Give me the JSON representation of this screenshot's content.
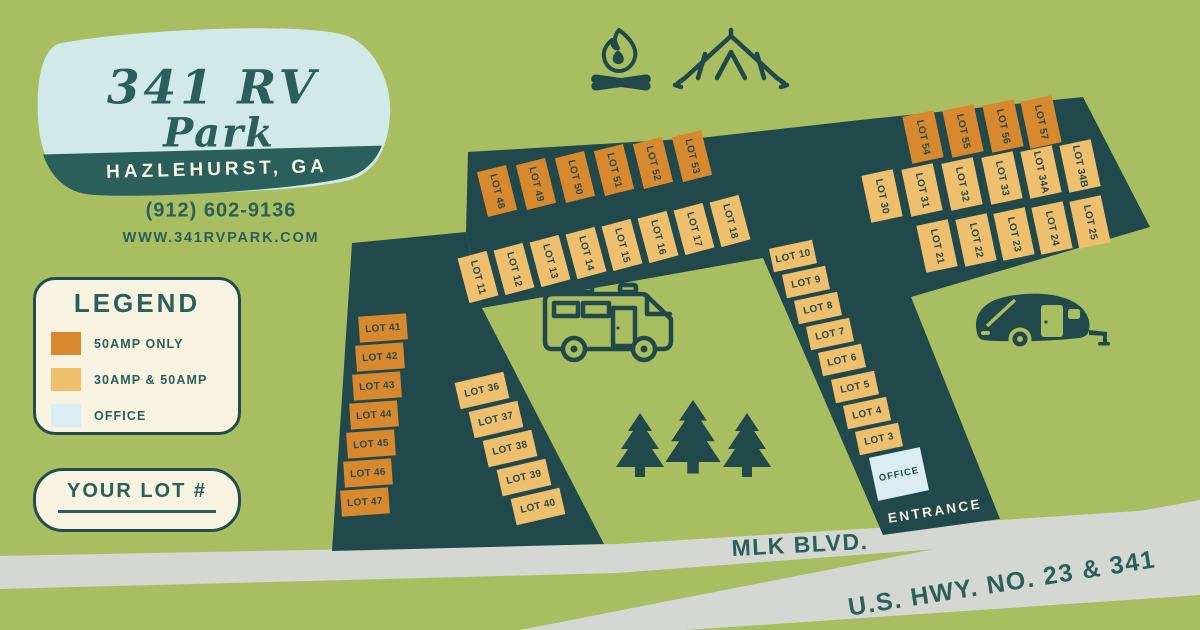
{
  "logo": {
    "title_line1": "341 RV",
    "title_line2": "Park",
    "banner": "HAZLEHURST, GA"
  },
  "contact": {
    "phone": "(912) 602-9136",
    "website": "WWW.341RVPARK.COM"
  },
  "legend": {
    "title": "LEGEND",
    "items": [
      {
        "label": "50AMP ONLY",
        "color": "#d8892e"
      },
      {
        "label": "30AMP & 50AMP",
        "color": "#eec06d"
      },
      {
        "label": "OFFICE",
        "color": "#d9edf2"
      }
    ]
  },
  "your_lot": {
    "label": "YOUR LOT #"
  },
  "map": {
    "entrance_label": "ENTRANCE",
    "roads": [
      {
        "label": "MLK BLVD."
      },
      {
        "label": "U.S. HWY. NO. 23 & 341"
      }
    ],
    "icons": [
      "campfire-icon",
      "tent-icon",
      "rv-motorhome-icon",
      "pine-trees-icon",
      "camper-trailer-icon"
    ],
    "lots": [
      {
        "label": "LOT 48",
        "type": "50amp",
        "x": 497,
        "y": 191,
        "w": 30,
        "h": 46,
        "r": -14,
        "v": true
      },
      {
        "label": "LOT 49",
        "type": "50amp",
        "x": 536,
        "y": 184,
        "w": 30,
        "h": 46,
        "r": -14,
        "v": true
      },
      {
        "label": "LOT 50",
        "type": "50amp",
        "x": 575,
        "y": 177,
        "w": 30,
        "h": 46,
        "r": -14,
        "v": true
      },
      {
        "label": "LOT 51",
        "type": "50amp",
        "x": 614,
        "y": 170,
        "w": 30,
        "h": 46,
        "r": -14,
        "v": true
      },
      {
        "label": "LOT 52",
        "type": "50amp",
        "x": 653,
        "y": 163,
        "w": 30,
        "h": 46,
        "r": -14,
        "v": true
      },
      {
        "label": "LOT 53",
        "type": "50amp",
        "x": 692,
        "y": 156,
        "w": 30,
        "h": 46,
        "r": -14,
        "v": true
      },
      {
        "label": "LOT 11",
        "type": "30_50amp",
        "x": 478,
        "y": 277,
        "w": 30,
        "h": 46,
        "r": -15,
        "v": true
      },
      {
        "label": "LOT 12",
        "type": "30_50amp",
        "x": 514,
        "y": 269,
        "w": 30,
        "h": 46,
        "r": -15,
        "v": true
      },
      {
        "label": "LOT 13",
        "type": "30_50amp",
        "x": 550,
        "y": 261,
        "w": 30,
        "h": 46,
        "r": -15,
        "v": true
      },
      {
        "label": "LOT 14",
        "type": "30_50amp",
        "x": 586,
        "y": 253,
        "w": 30,
        "h": 46,
        "r": -15,
        "v": true
      },
      {
        "label": "LOT 15",
        "type": "30_50amp",
        "x": 622,
        "y": 245,
        "w": 30,
        "h": 46,
        "r": -15,
        "v": true
      },
      {
        "label": "LOT 16",
        "type": "30_50amp",
        "x": 658,
        "y": 237,
        "w": 30,
        "h": 46,
        "r": -15,
        "v": true
      },
      {
        "label": "LOT 17",
        "type": "30_50amp",
        "x": 694,
        "y": 229,
        "w": 30,
        "h": 46,
        "r": -15,
        "v": true
      },
      {
        "label": "LOT 18",
        "type": "30_50amp",
        "x": 730,
        "y": 221,
        "w": 30,
        "h": 46,
        "r": -15,
        "v": true
      },
      {
        "label": "LOT 54",
        "type": "50amp",
        "x": 923,
        "y": 137,
        "w": 32,
        "h": 48,
        "r": -12,
        "v": true
      },
      {
        "label": "LOT 55",
        "type": "50amp",
        "x": 963,
        "y": 131,
        "w": 32,
        "h": 48,
        "r": -12,
        "v": true
      },
      {
        "label": "LOT 56",
        "type": "50amp",
        "x": 1003,
        "y": 126,
        "w": 32,
        "h": 48,
        "r": -12,
        "v": true
      },
      {
        "label": "LOT 57",
        "type": "50amp",
        "x": 1041,
        "y": 122,
        "w": 32,
        "h": 48,
        "r": -12,
        "v": true
      },
      {
        "label": "LOT 30",
        "type": "30_50amp",
        "x": 882,
        "y": 196,
        "w": 32,
        "h": 48,
        "r": -12,
        "v": true
      },
      {
        "label": "LOT 31",
        "type": "30_50amp",
        "x": 922,
        "y": 190,
        "w": 32,
        "h": 48,
        "r": -12,
        "v": true
      },
      {
        "label": "LOT 32",
        "type": "30_50amp",
        "x": 962,
        "y": 184,
        "w": 32,
        "h": 48,
        "r": -12,
        "v": true
      },
      {
        "label": "LOT 33",
        "type": "30_50amp",
        "x": 1002,
        "y": 178,
        "w": 32,
        "h": 48,
        "r": -12,
        "v": true
      },
      {
        "label": "LOT 34A",
        "type": "30_50amp",
        "x": 1041,
        "y": 172,
        "w": 32,
        "h": 48,
        "r": -12,
        "v": true
      },
      {
        "label": "LOT 34B",
        "type": "30_50amp",
        "x": 1080,
        "y": 166,
        "w": 32,
        "h": 48,
        "r": -12,
        "v": true
      },
      {
        "label": "LOT 21",
        "type": "30_50amp",
        "x": 937,
        "y": 246,
        "w": 32,
        "h": 48,
        "r": -12,
        "v": true
      },
      {
        "label": "LOT 22",
        "type": "30_50amp",
        "x": 976,
        "y": 240,
        "w": 32,
        "h": 48,
        "r": -12,
        "v": true
      },
      {
        "label": "LOT 23",
        "type": "30_50amp",
        "x": 1014,
        "y": 234,
        "w": 32,
        "h": 48,
        "r": -12,
        "v": true
      },
      {
        "label": "LOT 24",
        "type": "30_50amp",
        "x": 1052,
        "y": 228,
        "w": 32,
        "h": 48,
        "r": -12,
        "v": true
      },
      {
        "label": "LOT 25",
        "type": "30_50amp",
        "x": 1090,
        "y": 222,
        "w": 32,
        "h": 48,
        "r": -12,
        "v": true
      },
      {
        "label": "LOT 10",
        "type": "30_50amp",
        "x": 793,
        "y": 256,
        "w": 44,
        "h": 24,
        "r": -12,
        "v": false
      },
      {
        "label": "LOT 9",
        "type": "30_50amp",
        "x": 806,
        "y": 282,
        "w": 44,
        "h": 24,
        "r": -12,
        "v": false
      },
      {
        "label": "LOT 8",
        "type": "30_50amp",
        "x": 818,
        "y": 308,
        "w": 44,
        "h": 24,
        "r": -12,
        "v": false
      },
      {
        "label": "LOT 7",
        "type": "30_50amp",
        "x": 830,
        "y": 334,
        "w": 44,
        "h": 24,
        "r": -12,
        "v": false
      },
      {
        "label": "LOT 6",
        "type": "30_50amp",
        "x": 842,
        "y": 360,
        "w": 44,
        "h": 24,
        "r": -12,
        "v": false
      },
      {
        "label": "LOT 5",
        "type": "30_50amp",
        "x": 855,
        "y": 387,
        "w": 44,
        "h": 24,
        "r": -12,
        "v": false
      },
      {
        "label": "LOT 4",
        "type": "30_50amp",
        "x": 867,
        "y": 413,
        "w": 44,
        "h": 24,
        "r": -12,
        "v": false
      },
      {
        "label": "LOT 3",
        "type": "30_50amp",
        "x": 879,
        "y": 439,
        "w": 44,
        "h": 24,
        "r": -12,
        "v": false
      },
      {
        "label": "OFFICE",
        "type": "office",
        "x": 899,
        "y": 474,
        "w": 52,
        "h": 44,
        "r": -12,
        "v": false
      },
      {
        "label": "LOT 41",
        "type": "50amp",
        "x": 383,
        "y": 328,
        "w": 48,
        "h": 26,
        "r": -4,
        "v": false
      },
      {
        "label": "LOT 42",
        "type": "50amp",
        "x": 380,
        "y": 357,
        "w": 48,
        "h": 26,
        "r": -4,
        "v": false
      },
      {
        "label": "LOT 43",
        "type": "50amp",
        "x": 377,
        "y": 386,
        "w": 48,
        "h": 26,
        "r": -4,
        "v": false
      },
      {
        "label": "LOT 44",
        "type": "50amp",
        "x": 374,
        "y": 415,
        "w": 48,
        "h": 26,
        "r": -4,
        "v": false
      },
      {
        "label": "LOT 45",
        "type": "50amp",
        "x": 371,
        "y": 444,
        "w": 48,
        "h": 26,
        "r": -4,
        "v": false
      },
      {
        "label": "LOT 46",
        "type": "50amp",
        "x": 368,
        "y": 473,
        "w": 48,
        "h": 26,
        "r": -4,
        "v": false
      },
      {
        "label": "LOT 47",
        "type": "50amp",
        "x": 365,
        "y": 502,
        "w": 48,
        "h": 26,
        "r": -4,
        "v": false
      },
      {
        "label": "LOT 36",
        "type": "30_50amp",
        "x": 482,
        "y": 390,
        "w": 50,
        "h": 27,
        "r": -13,
        "v": false
      },
      {
        "label": "LOT 37",
        "type": "30_50amp",
        "x": 496,
        "y": 419,
        "w": 50,
        "h": 27,
        "r": -13,
        "v": false
      },
      {
        "label": "LOT 38",
        "type": "30_50amp",
        "x": 510,
        "y": 448,
        "w": 50,
        "h": 27,
        "r": -13,
        "v": false
      },
      {
        "label": "LOT 39",
        "type": "30_50amp",
        "x": 524,
        "y": 477,
        "w": 50,
        "h": 27,
        "r": -13,
        "v": false
      },
      {
        "label": "LOT 40",
        "type": "30_50amp",
        "x": 538,
        "y": 506,
        "w": 50,
        "h": 27,
        "r": -13,
        "v": false
      }
    ]
  },
  "colors": {
    "background_green": "#a8be61",
    "park_road_teal": "#21494b",
    "street_gray": "#d5d7d2",
    "lot_50amp": "#d8892e",
    "lot_30_50amp": "#eec06d",
    "office_blue": "#d9edf2",
    "cream": "#f8f2e0",
    "ink_teal": "#2b5f5b",
    "logo_blue": "#d2e9ea"
  }
}
